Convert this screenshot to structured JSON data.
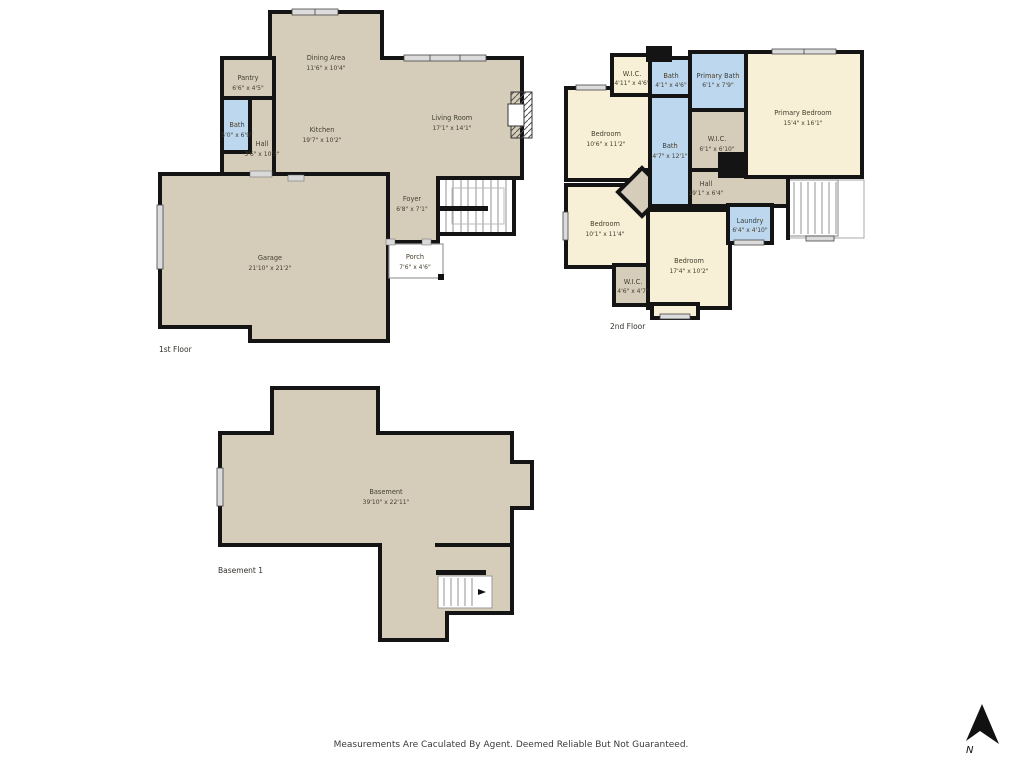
{
  "page": {
    "footer": "Measurements Are Caculated By Agent. Deemed Reliable But Not Guaranteed.",
    "compass_label": "N"
  },
  "colors": {
    "wall": "#141414",
    "floor_tan": "#d6ccba",
    "floor_cream": "#f8f0d6",
    "bath_blue": "#bdd7ef",
    "window_gray": "#dcdcdc"
  },
  "floors": {
    "first": {
      "label": "1st Floor",
      "rooms": {
        "dining": {
          "name": "Dining Area",
          "dims": "11'6\" x 10'4\""
        },
        "pantry": {
          "name": "Pantry",
          "dims": "6'6\" x 4'5\""
        },
        "bath": {
          "name": "Bath",
          "dims": "5'0\" x 6'9\""
        },
        "hall": {
          "name": "Hall",
          "dims": "3'6\" x 10'3\""
        },
        "kitchen": {
          "name": "Kitchen",
          "dims": "19'7\" x 10'2\""
        },
        "living": {
          "name": "Living Room",
          "dims": "17'1\" x 14'1\""
        },
        "foyer": {
          "name": "Foyer",
          "dims": "6'8\" x 7'1\""
        },
        "garage": {
          "name": "Garage",
          "dims": "21'10\" x 21'2\""
        },
        "porch": {
          "name": "Porch",
          "dims": "7'6\" x 4'6\""
        }
      }
    },
    "second": {
      "label": "2nd Floor",
      "rooms": {
        "wic_top": {
          "name": "W.I.C.",
          "dims": "4'11\" x 4'6\""
        },
        "bath_top": {
          "name": "Bath",
          "dims": "4'1\" x 4'6\""
        },
        "primary_bath": {
          "name": "Primary Bath",
          "dims": "6'1\" x 7'9\""
        },
        "primary_bedroom": {
          "name": "Primary Bedroom",
          "dims": "15'4\" x 16'1\""
        },
        "bedroom_nw": {
          "name": "Bedroom",
          "dims": "10'6\" x 11'2\""
        },
        "bath_mid": {
          "name": "Bath",
          "dims": "4'7\" x 12'1\""
        },
        "wic_mid": {
          "name": "W.I.C.",
          "dims": "6'1\" x 6'10\""
        },
        "hall": {
          "name": "Hall",
          "dims": "19'1\" x 6'4\""
        },
        "bedroom_sw": {
          "name": "Bedroom",
          "dims": "10'1\" x 11'4\""
        },
        "laundry": {
          "name": "Laundry",
          "dims": "6'4\" x 4'10\""
        },
        "bedroom_s": {
          "name": "Bedroom",
          "dims": "17'4\" x 10'2\""
        },
        "wic_s": {
          "name": "W.I.C.",
          "dims": "4'6\" x 4'7\""
        }
      }
    },
    "basement": {
      "label": "Basement 1",
      "rooms": {
        "basement": {
          "name": "Basement",
          "dims": "39'10\" x 22'11\""
        }
      }
    }
  }
}
